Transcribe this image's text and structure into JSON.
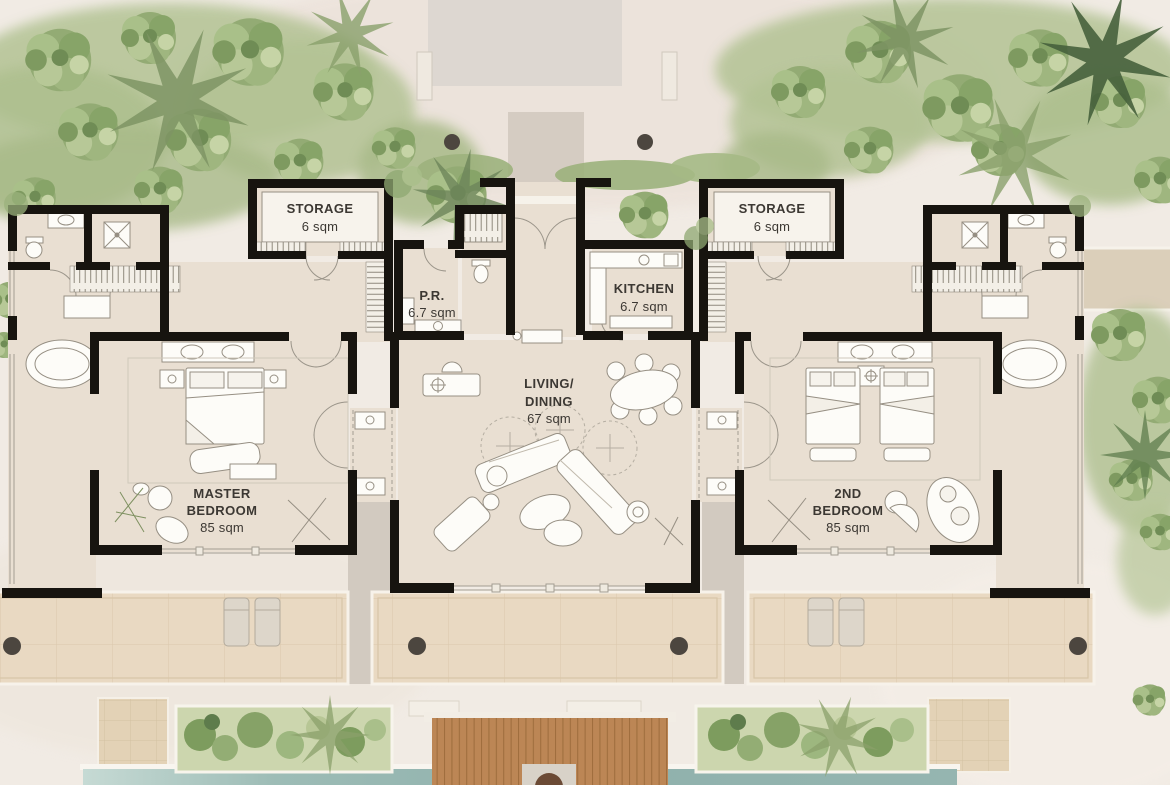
{
  "rooms": {
    "storage_left": {
      "name": "STORAGE",
      "area": "6 sqm"
    },
    "storage_right": {
      "name": "STORAGE",
      "area": "6 sqm"
    },
    "powder_room": {
      "name": "P.R.",
      "area": "6.7 sqm"
    },
    "kitchen": {
      "name": "KITCHEN",
      "area": "6.7 sqm"
    },
    "living_dining": {
      "line1": "LIVING/",
      "line2": "DINING",
      "area": "67 sqm"
    },
    "master_bedroom": {
      "line1": "MASTER",
      "line2": "BEDROOM",
      "area": "85 sqm"
    },
    "second_bedroom": {
      "line1": "2ND",
      "line2": "BEDROOM",
      "area": "85 sqm"
    }
  },
  "palette": {
    "wall": "#17140f",
    "interior_floor": "#e9dfd2",
    "sand": "#f1ebe4",
    "stone_terrace": "#e9d9c2",
    "timber_deck": "#c08a58",
    "pool_water": "#8fb1ac",
    "foliage_light": "#c3d2a3",
    "foliage_mid": "#93ab74",
    "foliage_dark": "#5e7c4c",
    "label_text": "#3c3833"
  }
}
